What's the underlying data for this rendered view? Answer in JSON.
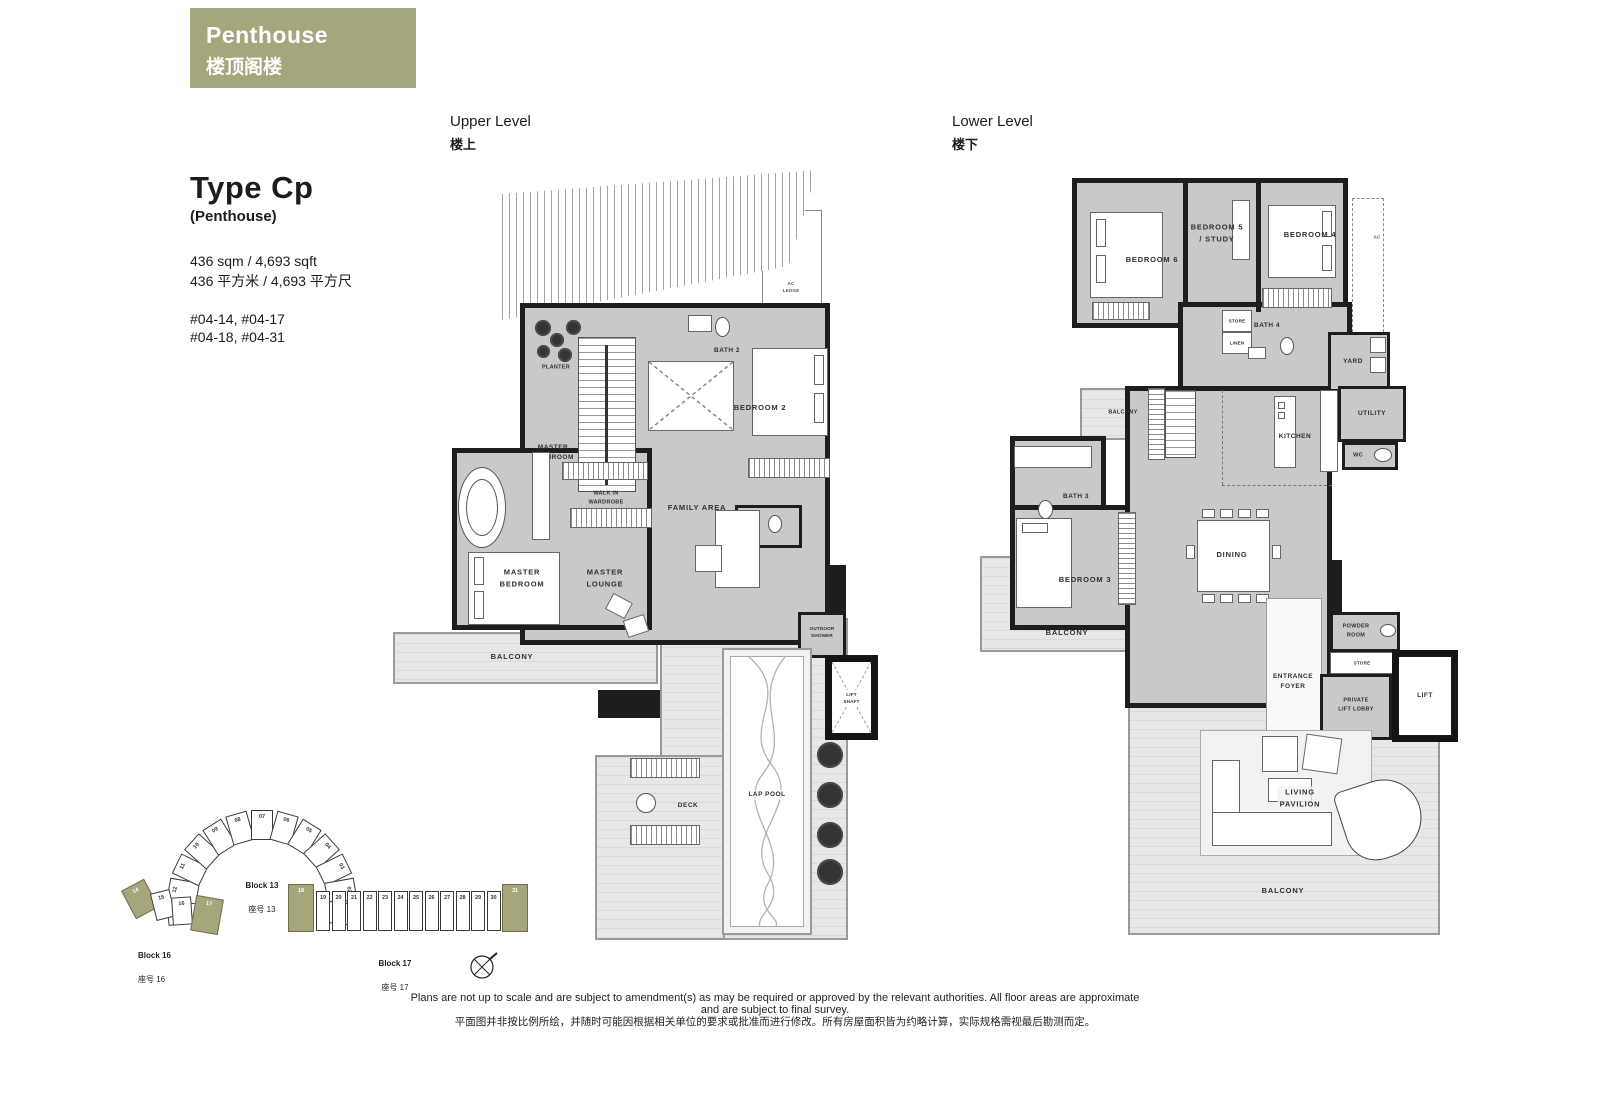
{
  "badge": {
    "title_en": "Penthouse",
    "title_zh": "楼顶阁楼"
  },
  "info": {
    "type_name": "Type Cp",
    "type_sub": "(Penthouse)",
    "area_en": "436 sqm / 4,693 sqft",
    "area_zh": "436 平方米 / 4,693 平方尺",
    "units_a": "#04-14, #04-17",
    "units_b": "#04-18, #04-31"
  },
  "upper": {
    "heading_en": "Upper Level",
    "heading_zh": "楼上",
    "rooms": {
      "planter": "PLANTER",
      "bath2": "BATH 2",
      "bedroom2": "BEDROOM 2",
      "master_bathroom": "MASTER\nBATHROOM",
      "walk_in_wardrobe": "WALK IN\nWARDROBE",
      "family_area": "FAMILY AREA",
      "master_bedroom": "MASTER\nBEDROOM",
      "master_lounge": "MASTER\nLOUNGE",
      "balcony": "BALCONY",
      "outdoor_shower": "OUTDOOR\nSHOWER",
      "lift_shaft": "LIFT\nSHAFT",
      "lap_pool": "LAP POOL",
      "deck": "DECK",
      "ac_ledge": "AC\nLEDGE"
    }
  },
  "lower": {
    "heading_en": "Lower Level",
    "heading_zh": "楼下",
    "rooms": {
      "bedroom6": "BEDROOM 6",
      "bedroom5_study": "BEDROOM 5\n/ STUDY",
      "bedroom4": "BEDROOM 4",
      "store_upper": "STORE",
      "linen": "LINEN",
      "bath4": "BATH 4",
      "yard": "YARD",
      "utility": "UTILITY",
      "wc": "WC",
      "kitchen": "KITCHEN",
      "balcony_upper": "BALCONY",
      "bath3": "BATH 3",
      "bedroom3": "BEDROOM 3",
      "dining": "DINING",
      "balcony_left": "BALCONY",
      "powder_room": "POWDER\nROOM",
      "store_lower": "STORE",
      "entrance_foyer": "ENTRANCE\nFOYER",
      "private_lift_lobby": "PRIVATE\nLIFT LOBBY",
      "lift": "LIFT",
      "living_pavilion": "LIVING\nPAVILION",
      "balcony_lower": "BALCONY",
      "ac": "AC"
    }
  },
  "siteplan": {
    "block13": {
      "label_en": "Block 13",
      "label_zh": "座号 13",
      "units": [
        "13",
        "12",
        "11",
        "10",
        "09",
        "08",
        "07",
        "06",
        "05",
        "04",
        "03",
        "02",
        "01"
      ]
    },
    "block16": {
      "label_en": "Block 16",
      "label_zh": "座号 16",
      "units": [
        "14",
        "15",
        "16",
        "17"
      ]
    },
    "block17": {
      "label_en": "Block 17",
      "label_zh": "座号 17",
      "units": [
        "18",
        "19",
        "20",
        "21",
        "22",
        "23",
        "24",
        "25",
        "26",
        "27",
        "28",
        "29",
        "30",
        "31"
      ]
    }
  },
  "footer": {
    "line_en": "Plans are not up to scale and are subject to amendment(s) as may be required or approved by the relevant authorities. All floor areas are approximate and are subject to final survey.",
    "line_zh": "平面图并非按比例所绘，并随时可能因根据相关单位的要求或批准而进行修改。所有房屋面积皆为约略计算，实际规格需视最后勘测而定。"
  },
  "colors": {
    "accent": "#a5a67c",
    "wall": "#1d1d1d",
    "floor": "#c9c9c9",
    "outdoor": "#e7e7e7"
  }
}
